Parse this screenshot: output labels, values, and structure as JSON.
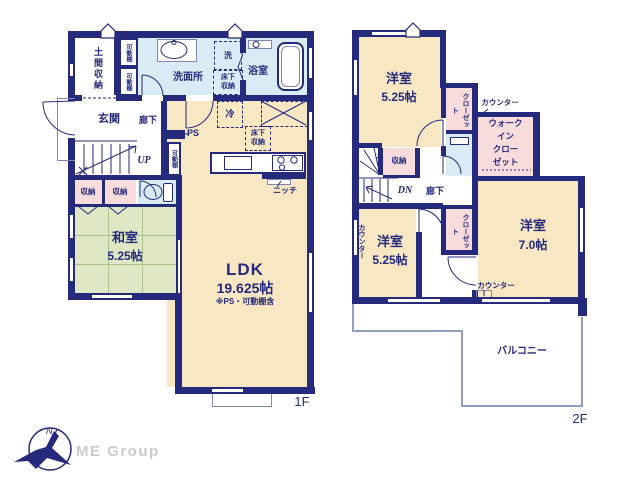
{
  "colors": {
    "wall": "#262a7c",
    "room_cream": "#f7e7c3",
    "tatami_green": "#dfe8c5",
    "wet_blue": "#d9ecf5",
    "storage_pink": "#f8dcdc",
    "thin_line": "#8087b4",
    "logo_gray": "#cbcbcb"
  },
  "floor1": {
    "floor_label": "1F",
    "rooms": {
      "doma_storage": "土間収納",
      "washroom": "洗面所",
      "bathroom": "浴室",
      "entrance": "玄関",
      "hallway": "廊下",
      "japanese_room": {
        "name": "和室",
        "size": "5.25帖"
      },
      "ldk": {
        "name": "LDK",
        "size": "19.625帖",
        "note": "※PS・可動棚含"
      }
    },
    "labels": {
      "movable_shelf_a": "可動棚",
      "movable_shelf_b": "可動棚",
      "movable_shelf_c": "可動棚",
      "washer": "洗",
      "underfloor_storage_1": [
        "床下",
        "収納"
      ],
      "underfloor_storage_2": [
        "床下",
        "収納"
      ],
      "fridge": "冷",
      "ps": "PS",
      "up": "UP",
      "storage_a": "収納",
      "storage_b": "収納",
      "niche": "ニッチ"
    }
  },
  "floor2": {
    "floor_label": "2F",
    "rooms": {
      "west_room_top": {
        "name": "洋室",
        "size": "5.25帖"
      },
      "west_room_left": {
        "name": "洋室",
        "size": "5.25帖"
      },
      "west_room_right": {
        "name": "洋室",
        "size": "7.0帖"
      },
      "balcony": "バルコニー",
      "hallway": "廊下"
    },
    "labels": {
      "closet_top": "クローゼット",
      "closet_mid": "クローゼット",
      "wic_lines": [
        "ウォーク",
        "イン",
        "クロー",
        "ゼット"
      ],
      "counter_top": "カウンター",
      "counter_left": "カウンター",
      "counter_bottom": "カウンター",
      "storage": "収納",
      "dn": "DN"
    }
  },
  "logo": {
    "company": "ME Group",
    "north": "N"
  }
}
